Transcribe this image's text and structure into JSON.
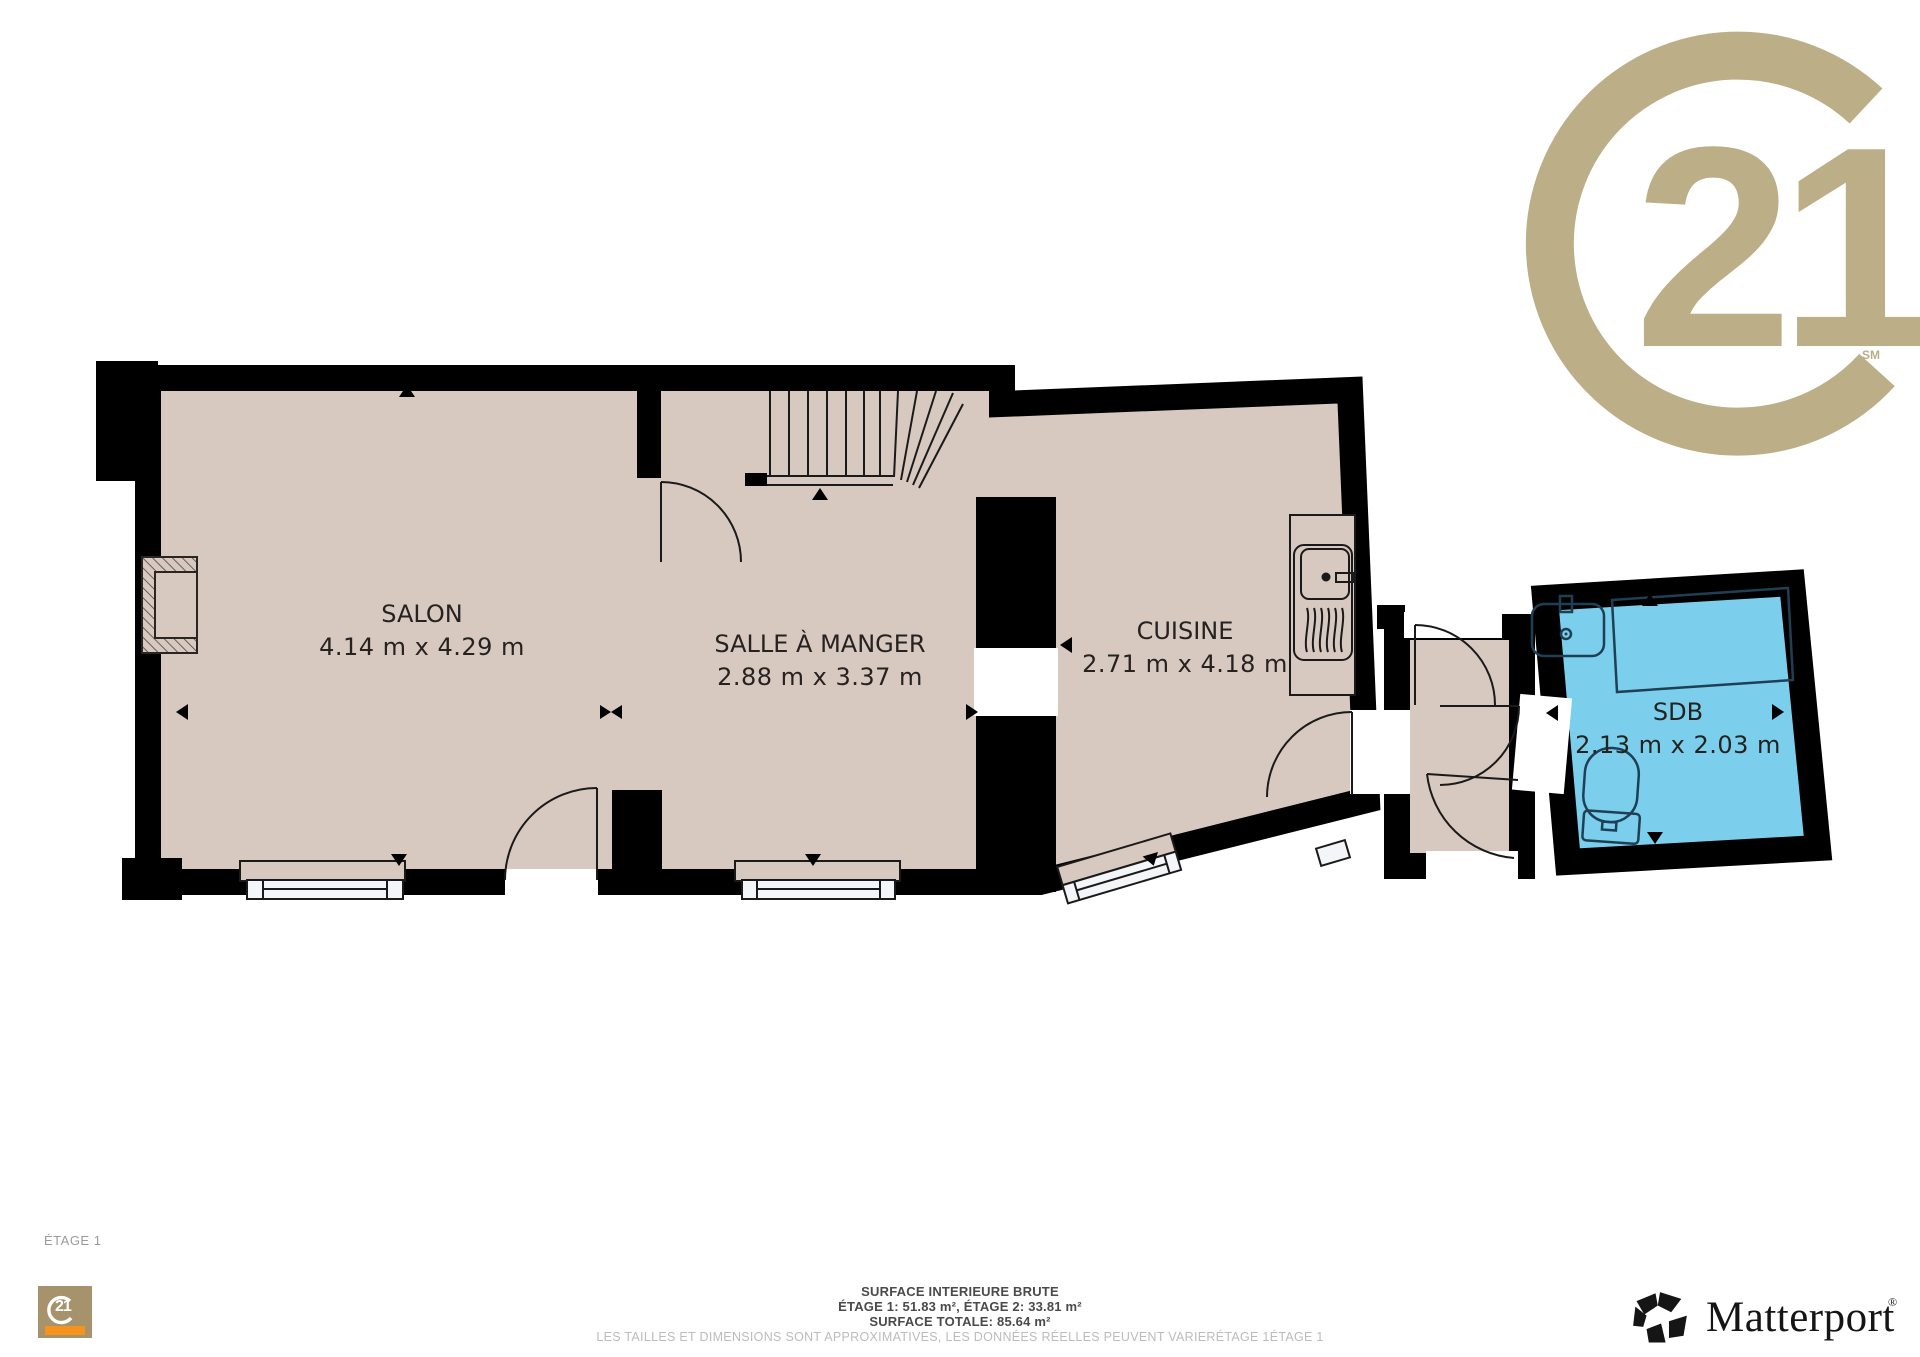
{
  "branding": {
    "century21": {
      "number": "21",
      "service_mark": "SM",
      "color": "#bcae86"
    },
    "century21_square": {
      "number": "21"
    },
    "matterport": {
      "wordmark": "Matterport",
      "registered": "®"
    }
  },
  "floor": {
    "label": "ÉTAGE 1"
  },
  "rooms": {
    "salon": {
      "name": "SALON",
      "dims": "4.14 m x 4.29 m"
    },
    "salle_a_manger": {
      "name": "SALLE À MANGER",
      "dims": "2.88 m x 3.37 m"
    },
    "cuisine": {
      "name": "CUISINE",
      "dims": "2.71 m x 4.18 m"
    },
    "sdb": {
      "name": "SDB",
      "dims": "2.13 m x 2.03 m"
    }
  },
  "footer": {
    "line1": "SURFACE INTERIEURE BRUTE",
    "line2": "ÉTAGE 1: 51.83 m², ÉTAGE 2: 33.81 m²",
    "line3": "SURFACE TOTALE: 85.64 m²",
    "disclaimer": "LES TAILLES ET DIMENSIONS SONT APPROXIMATIVES, LES DONNÉES RÉELLES PEUVENT VARIERÉTAGE 1ÉTAGE 1"
  },
  "colors": {
    "floor": "#d7c9c0",
    "bathroom": "#7bcfec",
    "walls": "#000000",
    "fixture_outline": "#1f3f54",
    "accent_gold": "#bcae86",
    "matterport_black": "#151515"
  }
}
